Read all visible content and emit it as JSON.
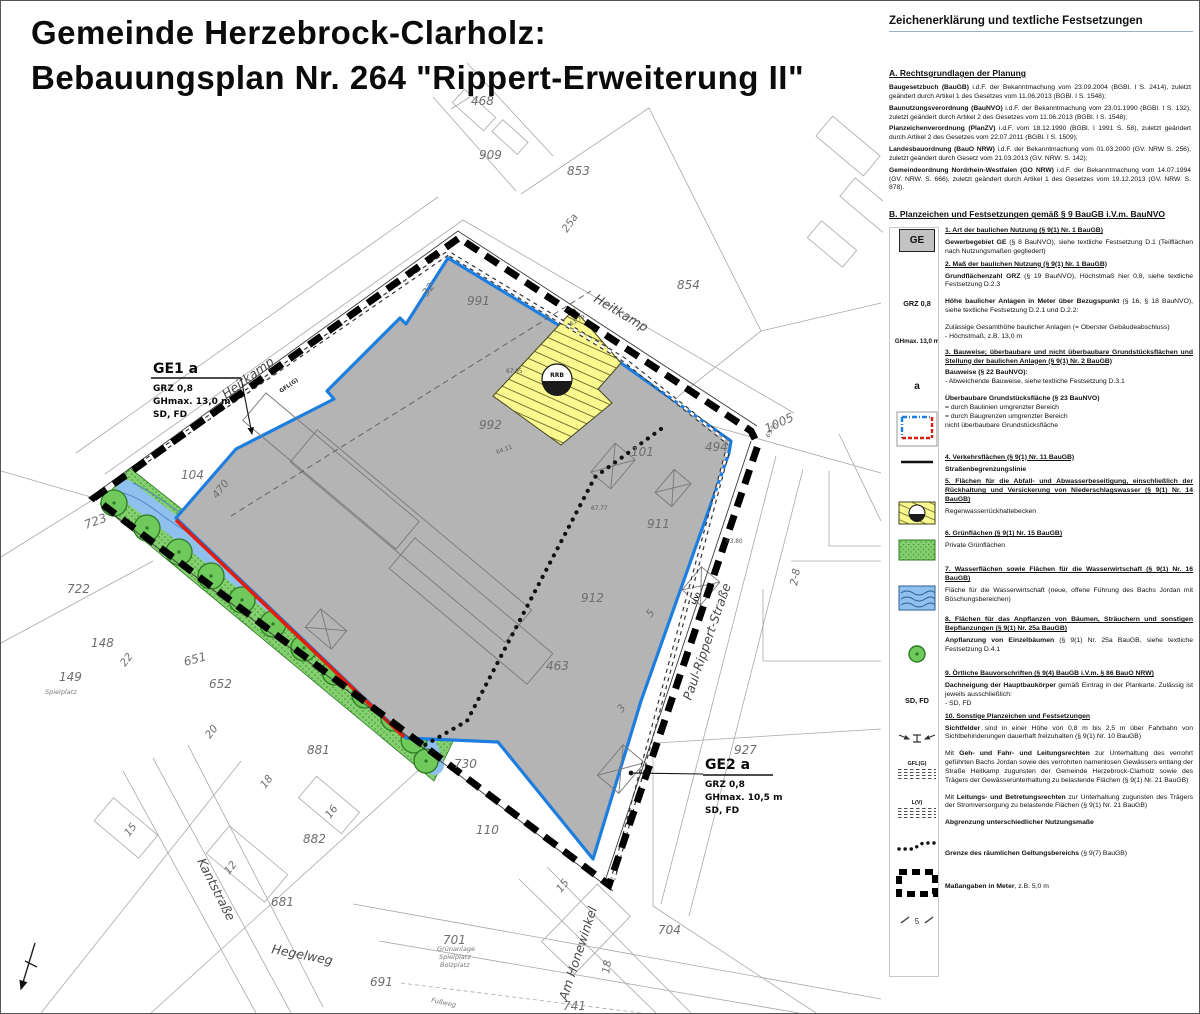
{
  "title": {
    "line1": "Gemeinde Herzebrock-Clarholz:",
    "line2": "Bebauungsplan Nr. 264 \"Rippert-Erweiterung II\""
  },
  "colors": {
    "plan_gray": "#b4b4b4",
    "baulinie_blue": "#1d7ee0",
    "baugrenze_red": "#e11d0e",
    "rrb_yellow": "#f9f98f",
    "green_area": "#85d06e",
    "water_blue": "#8fc0ee"
  },
  "legend": {
    "title": "Zeichenerklärung und textliche Festsetzungen",
    "a": {
      "heading": "A.   Rechtsgrundlagen der Planung",
      "items": [
        {
          "lead": "Baugesetzbuch (BauGB)",
          "rest": " i.d.F. der Bekanntmachung vom 23.09.2004 (BGBl. I S. 2414), zuletzt geändert durch Artikel 1 des Gesetzes vom 11.06.2013 (BGBl. I S. 1548);"
        },
        {
          "lead": "Baunutzungsverordnung (BauNVO)",
          "rest": " i.d.F. der Bekanntmachung vom 23.01.1990 (BGBl. I S. 132), zuletzt geändert durch Artikel 2 des Gesetzes vom 11.06.2013 (BGBl. I S. 1548);"
        },
        {
          "lead": "Planzeichenverordnung (PlanZV)",
          "rest": " i.d.F. vom 18.12.1990 (BGBl. I 1991 S. 58), zuletzt geändert durch Artikel 2 des Gesetzes vom 22.07.2011 (BGBl. I S. 1509);"
        },
        {
          "lead": "Landesbauordnung (BauO NRW)",
          "rest": " i.d.F. der Bekanntmachung vom 01.03.2000 (GV. NRW S. 256), zuletzt geändert durch Gesetz vom 21.03.2013 (GV. NRW. S. 142);"
        },
        {
          "lead": "Gemeindeordnung Nordrhein-Westfalen (GO NRW)",
          "rest": " i.d.F. der Bekanntmachung vom 14.07.1994 (GV. NRW. S. 666), zuletzt geändert durch Artikel 1 des Gesetzes vom 19.12.2013 (GV. NRW. S. 878)."
        }
      ]
    },
    "b": {
      "heading": "B.   Planzeichen und Festsetzungen gemäß § 9 BauGB i.V.m. BauNVO",
      "sym_ge": "GE",
      "sym_grz": "GRZ 0,8",
      "sym_gh": "GHmax. 13,0 m",
      "sym_a": "a",
      "sym_sdfd": "SD, FD",
      "sym_gfl": "GFL(G)",
      "sym_lv": "L(V)",
      "sym_rrb": "RRB",
      "sym_mass": "5",
      "h1": "1.  Art der baulichen Nutzung (§ 9(1) Nr. 1 BauGB)",
      "b1_lead": "Gewerbegebiet GE",
      "b1_rest": "  (§ 8 BauNVO), siehe textliche Festsetzung D.1 (Teilflächen nach Nutzungsmaßen gegliedert)",
      "h2": "2.  Maß der baulichen Nutzung (§ 9(1) Nr. 1 BauGB)",
      "b2a_lead": "Grundflächenzahl GRZ",
      "b2a_rest": " (§ 19 BauNVO), Höchstmaß hier 0,8, siehe textliche Festsetzung D.2.3",
      "b2b_lead": "Höhe baulicher Anlagen in Meter über Bezugspunkt",
      "b2b_rest": " (§ 16, § 18 BauNVO), siehe textliche Festsetzung D.2.1 und D.2.2:",
      "b2c_line1": "Zulässige Gesamthöhe baulicher Anlagen (= Oberster Gebäudeabschluss)",
      "b2c_line2": "- Höchstmaß, z.B. 13,0 m",
      "h3": "3.  Bauweise; überbaubare und nicht überbaubare Grundstücksflächen und Stellung der baulichen Anlagen (§ 9(1) Nr. 2 BauGB)",
      "b3a_lead": "Bauweise (§ 22 BauNVO):",
      "b3a_line": "- Abweichende Bauweise, siehe textliche Festsetzung D.3.1",
      "b3b_lead": "Überbaubare Grundstücksfläche (§ 23 BauNVO)",
      "b3b_p1": "= durch Baulinien umgrenzter Bereich",
      "b3b_p2": "= durch Baugrenzen umgrenzter Bereich",
      "b3b_p3": "nicht überbaubare Grundstücksfläche",
      "h4": "4.  Verkehrsflächen (§ 9(1) Nr. 11 BauGB)",
      "b4": "Straßenbegrenzungslinie",
      "h5": "5.  Flächen für die Abfall- und Abwasserbeseitigung, einschließlich der Rückhaltung und Versickerung von Niederschlagswasser (§ 9(1) Nr. 14 BauGB)",
      "b5": "Regenwasserrückhaltebecken",
      "h6": "6.  Grünflächen (§ 9(1) Nr. 15 BauGB)",
      "b6": "Private Grünflächen",
      "h7": "7.  Wasserflächen sowie Flächen für die Wasserwirtschaft (§ 9(1) Nr. 16 BauGB)",
      "b7": "Fläche für die Wasserwirtschaft (neue, offene Führung des Bachs Jordan mit Böschungsbereichen)",
      "h8": "8.  Flächen für das Anpflanzen von Bäumen, Sträuchern und sonstigen Bepflanzungen (§ 9(1) Nr. 25a BauGB)",
      "b8_lead": "Anpflanzung von Einzelbäumen",
      "b8_rest": " (§ 9(1) Nr. 25a BauGB, siehe textliche Festsetzung D.4.1",
      "h9": "9.  Örtliche Bauvorschriften (§ 9(4) BauGB i.V.m. § 86 BauO NRW)",
      "b9_lead": "Dachneigung der Hauptbaukörper",
      "b9_rest": " gemäß Eintrag in der Plankarte. Zulässig ist jeweils ausschließlich:",
      "b9_line2": "- SD, FD",
      "h10": "10. Sonstige Planzeichen und Festsetzungen",
      "b10a_lead": "Sichtfelder",
      "b10a_rest": " sind in einer Höhe von 0,8 m bis 2,5 m über Fahrbahn von Sichtbehinderungen dauerhaft freizuhalten (§ 9(1) Nr. 10 BauGB)",
      "b10b_pre": "Mit ",
      "b10b_lead": "Geh- und Fahr- und Leitungsrechten",
      "b10b_rest": " zur Unterhaltung des verrohrt geführten Bachs Jordan sowie des verrohrten namenlosen Gewässers entlang der Straße Heitkamp zugunsten der Gemeinde Herzebrock-Clarholz sowie des Trägers der Gewässerunterhaltung zu belastende Flächen (§ 9(1) Nr. 21 BauGB)",
      "b10c_pre": "Mit ",
      "b10c_lead": "Leitungs- und Betretungsrechten",
      "b10c_rest": " zur Unterhaltung zugunsten des Trägers der Stromversorgung zu belastende Flächen (§ 9(1) Nr. 21 BauGB)",
      "b10d": "Abgrenzung unterschiedlicher Nutzungsmaße",
      "b10e_lead": "Grenze des räumlichen Geltungsbereichs",
      "b10e_rest": " (§ 9(7) BauGB)",
      "b10f_lead": "Maßangaben in Meter",
      "b10f_rest": ", z.B. 5,0 m"
    }
  },
  "map": {
    "rrb_label": "RRB",
    "labels": [
      {
        "t": "Heitkamp",
        "x": 225,
        "y": 398,
        "r": -36,
        "cls": "street"
      },
      {
        "t": "Heitkamp",
        "x": 592,
        "y": 300,
        "r": 31,
        "cls": "street"
      },
      {
        "t": "Paul-Rippert-Straße",
        "x": 690,
        "y": 700,
        "r": -71,
        "cls": "street"
      },
      {
        "t": "Kantstraße",
        "x": 196,
        "y": 860,
        "r": 63,
        "cls": "street"
      },
      {
        "t": "Hegelweg",
        "x": 270,
        "y": 952,
        "r": 11,
        "cls": "street"
      },
      {
        "t": "Am Honewinkel",
        "x": 566,
        "y": 1000,
        "r": -72,
        "cls": "street"
      },
      {
        "t": "468",
        "x": 470,
        "y": 104,
        "cls": "p"
      },
      {
        "t": "909",
        "x": 478,
        "y": 158,
        "cls": "p"
      },
      {
        "t": "853",
        "x": 566,
        "y": 174,
        "cls": "p"
      },
      {
        "t": "25a",
        "x": 566,
        "y": 232,
        "r": -55,
        "cls": "p2"
      },
      {
        "t": "854",
        "x": 676,
        "y": 288,
        "cls": "p"
      },
      {
        "t": "32",
        "x": 426,
        "y": 296,
        "r": -52,
        "cls": "p2"
      },
      {
        "t": "991",
        "x": 466,
        "y": 304,
        "cls": "p"
      },
      {
        "t": "992",
        "x": 478,
        "y": 428,
        "cls": "p"
      },
      {
        "t": "101",
        "x": 630,
        "y": 455,
        "cls": "p"
      },
      {
        "t": "494",
        "x": 704,
        "y": 450,
        "cls": "p"
      },
      {
        "t": "1005",
        "x": 766,
        "y": 432,
        "r": -25,
        "cls": "p"
      },
      {
        "t": "911",
        "x": 646,
        "y": 527,
        "cls": "p"
      },
      {
        "t": "912",
        "x": 580,
        "y": 601,
        "cls": "p"
      },
      {
        "t": "463",
        "x": 545,
        "y": 669,
        "cls": "p"
      },
      {
        "t": "927",
        "x": 733,
        "y": 753,
        "cls": "p"
      },
      {
        "t": "2-8",
        "x": 796,
        "y": 585,
        "r": -80,
        "cls": "p2"
      },
      {
        "t": "5",
        "x": 650,
        "y": 617,
        "r": -52,
        "cls": "p2"
      },
      {
        "t": "3",
        "x": 621,
        "y": 712,
        "r": -52,
        "cls": "p2"
      },
      {
        "t": "104",
        "x": 180,
        "y": 478,
        "cls": "p"
      },
      {
        "t": "470",
        "x": 216,
        "y": 498,
        "r": -52,
        "cls": "p2"
      },
      {
        "t": "723",
        "x": 85,
        "y": 528,
        "r": -20,
        "cls": "p"
      },
      {
        "t": "722",
        "x": 66,
        "y": 592,
        "cls": "p"
      },
      {
        "t": "148",
        "x": 90,
        "y": 646,
        "cls": "p"
      },
      {
        "t": "149",
        "x": 58,
        "y": 680,
        "cls": "p"
      },
      {
        "t": "651",
        "x": 184,
        "y": 665,
        "r": -15,
        "cls": "p"
      },
      {
        "t": "652",
        "x": 208,
        "y": 687,
        "cls": "p"
      },
      {
        "t": "881",
        "x": 306,
        "y": 753,
        "cls": "p"
      },
      {
        "t": "882",
        "x": 302,
        "y": 842,
        "cls": "p"
      },
      {
        "t": "681",
        "x": 270,
        "y": 905,
        "cls": "p"
      },
      {
        "t": "691",
        "x": 369,
        "y": 985,
        "cls": "p"
      },
      {
        "t": "701",
        "x": 442,
        "y": 943,
        "cls": "p"
      },
      {
        "t": "110",
        "x": 475,
        "y": 833,
        "cls": "p"
      },
      {
        "t": "730",
        "x": 453,
        "y": 767,
        "cls": "p"
      },
      {
        "t": "704",
        "x": 657,
        "y": 933,
        "cls": "p"
      },
      {
        "t": "741",
        "x": 562,
        "y": 1009,
        "cls": "p"
      },
      {
        "t": "15",
        "x": 128,
        "y": 836,
        "r": -52,
        "cls": "p2"
      },
      {
        "t": "12",
        "x": 228,
        "y": 874,
        "r": -52,
        "cls": "p2"
      },
      {
        "t": "16",
        "x": 329,
        "y": 818,
        "r": -52,
        "cls": "p2"
      },
      {
        "t": "22",
        "x": 124,
        "y": 666,
        "r": -52,
        "cls": "p2"
      },
      {
        "t": "20",
        "x": 209,
        "y": 738,
        "r": -52,
        "cls": "p2"
      },
      {
        "t": "18",
        "x": 264,
        "y": 788,
        "r": -52,
        "cls": "p2"
      },
      {
        "t": "15",
        "x": 560,
        "y": 892,
        "r": -52,
        "cls": "p2"
      },
      {
        "t": "18",
        "x": 608,
        "y": 973,
        "r": -80,
        "cls": "p2"
      },
      {
        "t": "Spielplatz",
        "x": 44,
        "y": 693,
        "cls": "tiny"
      },
      {
        "t": "Grünanlage",
        "x": 436,
        "y": 950,
        "cls": "tiny"
      },
      {
        "t": "Spielplatz",
        "x": 438,
        "y": 958,
        "cls": "tiny"
      },
      {
        "t": "Bolzplatz",
        "x": 439,
        "y": 966,
        "cls": "tiny"
      },
      {
        "t": "Fußweg",
        "x": 430,
        "y": 1001,
        "r": 12,
        "cls": "tiny"
      },
      {
        "t": "GFL(G)",
        "x": 280,
        "y": 392,
        "r": -35,
        "cls": "gfl"
      },
      {
        "t": "L(V)",
        "x": 694,
        "y": 604,
        "r": -66,
        "cls": "gfl"
      },
      {
        "t": "61.79",
        "x": 570,
        "y": 325,
        "r": -30,
        "cls": "elev"
      },
      {
        "t": "67.95",
        "x": 505,
        "y": 372,
        "cls": "elev"
      },
      {
        "t": "67.77",
        "x": 590,
        "y": 509,
        "cls": "elev"
      },
      {
        "t": "64.11",
        "x": 496,
        "y": 453,
        "r": -20,
        "cls": "elev"
      },
      {
        "t": "63.93",
        "x": 768,
        "y": 437,
        "r": -60,
        "cls": "elev"
      },
      {
        "t": "63.80",
        "x": 725,
        "y": 542,
        "cls": "elev"
      },
      {
        "t": "GE1  a",
        "x": 152,
        "y": 372,
        "cls": "annobig"
      },
      {
        "t": "GRZ 0,8",
        "x": 152,
        "y": 390,
        "cls": "anno"
      },
      {
        "t": "GHmax. 13,0 m",
        "x": 152,
        "y": 403,
        "cls": "anno"
      },
      {
        "t": "SD, FD",
        "x": 152,
        "y": 416,
        "cls": "anno"
      },
      {
        "t": "GE2  a",
        "x": 704,
        "y": 768,
        "cls": "annobig"
      },
      {
        "t": "GRZ 0,8",
        "x": 704,
        "y": 786,
        "cls": "anno"
      },
      {
        "t": "GHmax. 10,5 m",
        "x": 704,
        "y": 799,
        "cls": "anno"
      },
      {
        "t": "SD, FD",
        "x": 704,
        "y": 812,
        "cls": "anno"
      }
    ]
  }
}
